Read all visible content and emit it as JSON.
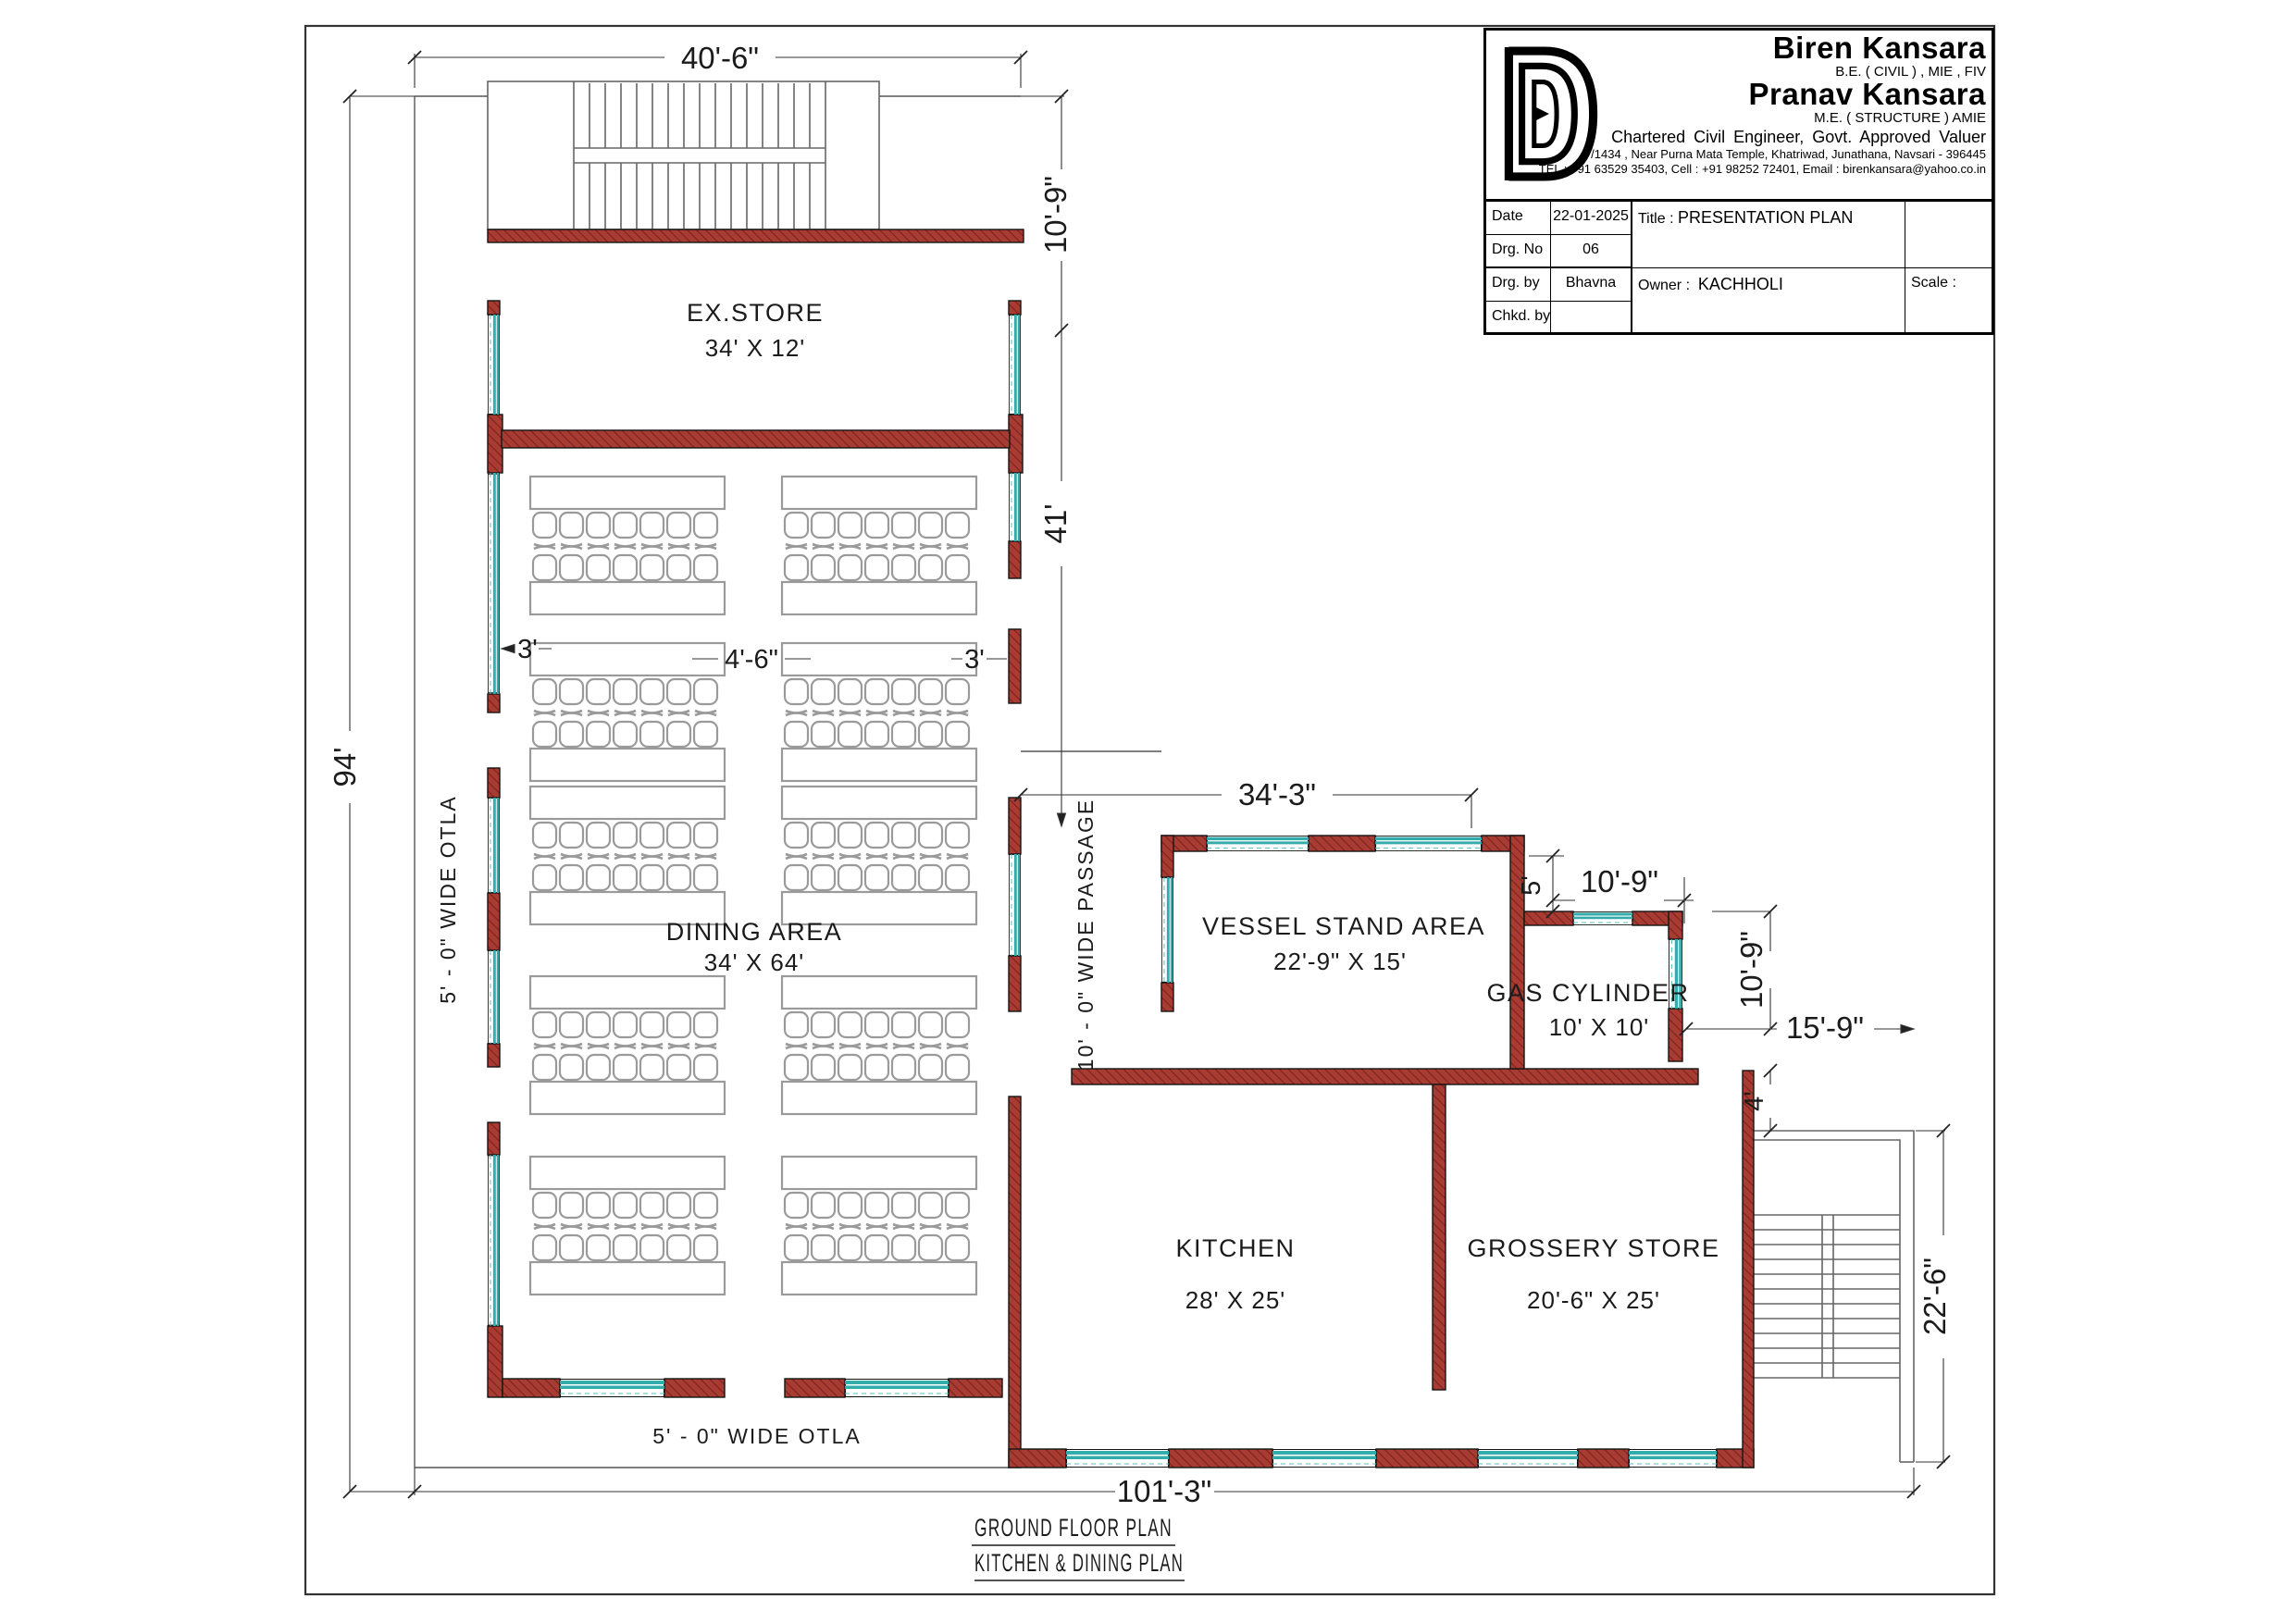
{
  "titleblock": {
    "logo_icon": "BD-monogram",
    "name1": "Biren Kansara",
    "cred1": "B.E. ( CIVIL ) , MIE , FIV",
    "name2": "Pranav Kansara",
    "cred2": "M.E. ( STRUCTURE ) AMIE",
    "profession": "Chartered Civil Engineer, Govt. Approved Valuer",
    "address": "7/1434 , Near Purna Mata Temple, Khatriwad, Junathana, Navsari - 396445",
    "contact": "TEL : +91 63529  35403, Cell : +91 98252 72401,  Email :  birenkansara@yahoo.co.in",
    "fields": {
      "date_label": "Date",
      "date_value": "22-01-2025",
      "drg_no_label": "Drg. No",
      "drg_no_value": "06",
      "drg_by_label": "Drg. by",
      "drg_by_value": "Bhavna",
      "chkd_by_label": "Chkd. by",
      "chkd_by_value": "",
      "title_label": "Title :",
      "title_value": "PRESENTATION PLAN",
      "owner_label": "Owner :",
      "owner_value": "KACHHOLI",
      "scale_label": "Scale :",
      "scale_value": ""
    }
  },
  "rooms": {
    "exstore": {
      "name": "EX.STORE",
      "size": "34' X 12'"
    },
    "dining": {
      "name": "DINING AREA",
      "size": "34' X 64'"
    },
    "vessel": {
      "name": "VESSEL STAND  AREA",
      "size": "22'-9\" X 15'"
    },
    "gas": {
      "name": "GAS CYLINDER",
      "size": "10' X 10'"
    },
    "kitchen": {
      "name": "KITCHEN",
      "size": "28' X 25'"
    },
    "grossery": {
      "name": "GROSSERY STORE",
      "size": "20'-6\" X 25'"
    },
    "otla_left": "5' - 0\"  WIDE  OTLA",
    "otla_bottom": "5' - 0\"  WIDE  OTLA",
    "passage": "10' - 0\"  WIDE  PASSAGE"
  },
  "dimensions": {
    "top_width": "40'-6\"",
    "stair_depth": "10'-9\"",
    "gap_left": "3'",
    "gap_mid": "4'-6\"",
    "gap_right": "3'",
    "overall_height": "94'",
    "dining_length": "41'",
    "vessel_width": "34'-3\"",
    "step": "5'",
    "gas_width": "10'-9\"",
    "gas_height": "10'-9\"",
    "right_ext": "15'-9\"",
    "wall_offset": "4'",
    "stair_height": "22'-6\"",
    "total_width": "101'-3\""
  },
  "footer": {
    "line1": "GROUND  FLOOR  PLAN",
    "line2": "KITCHEN & DINING  PLAN"
  },
  "colors": {
    "wall": "#A83B32",
    "wall_hatch": "#7A231E",
    "window": "#35ACAC",
    "furniture_outline": "#9A9A9A"
  }
}
